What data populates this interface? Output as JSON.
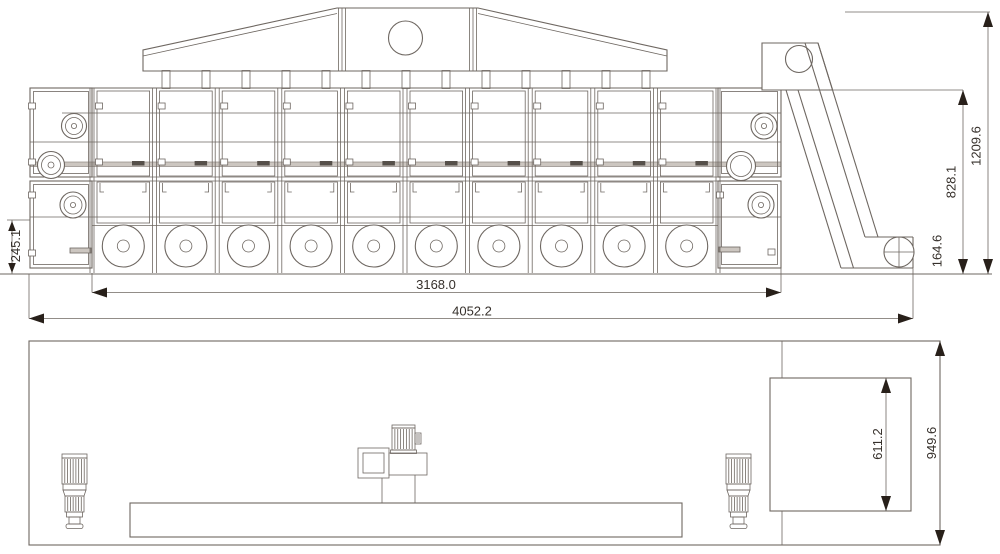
{
  "dimensions": {
    "side_view": {
      "inlet_height": "245.1",
      "chamber_length": "3168.0",
      "overall_length": "4052.2",
      "body_height": "828.1",
      "overall_height": "1209.6",
      "discharge_height": "164.6"
    },
    "plan_view": {
      "elevator_length": "611.2",
      "overall_width": "949.6"
    }
  },
  "structure": {
    "module_count": 10,
    "fan_count": 10,
    "hood_duct_count": 13,
    "divider_count": 11,
    "motor_count": 3
  },
  "colors": {
    "line": "#6e6761",
    "accent_dark": "#28201a",
    "belt_gray": "#ccc6c0",
    "background": "#ffffff"
  }
}
